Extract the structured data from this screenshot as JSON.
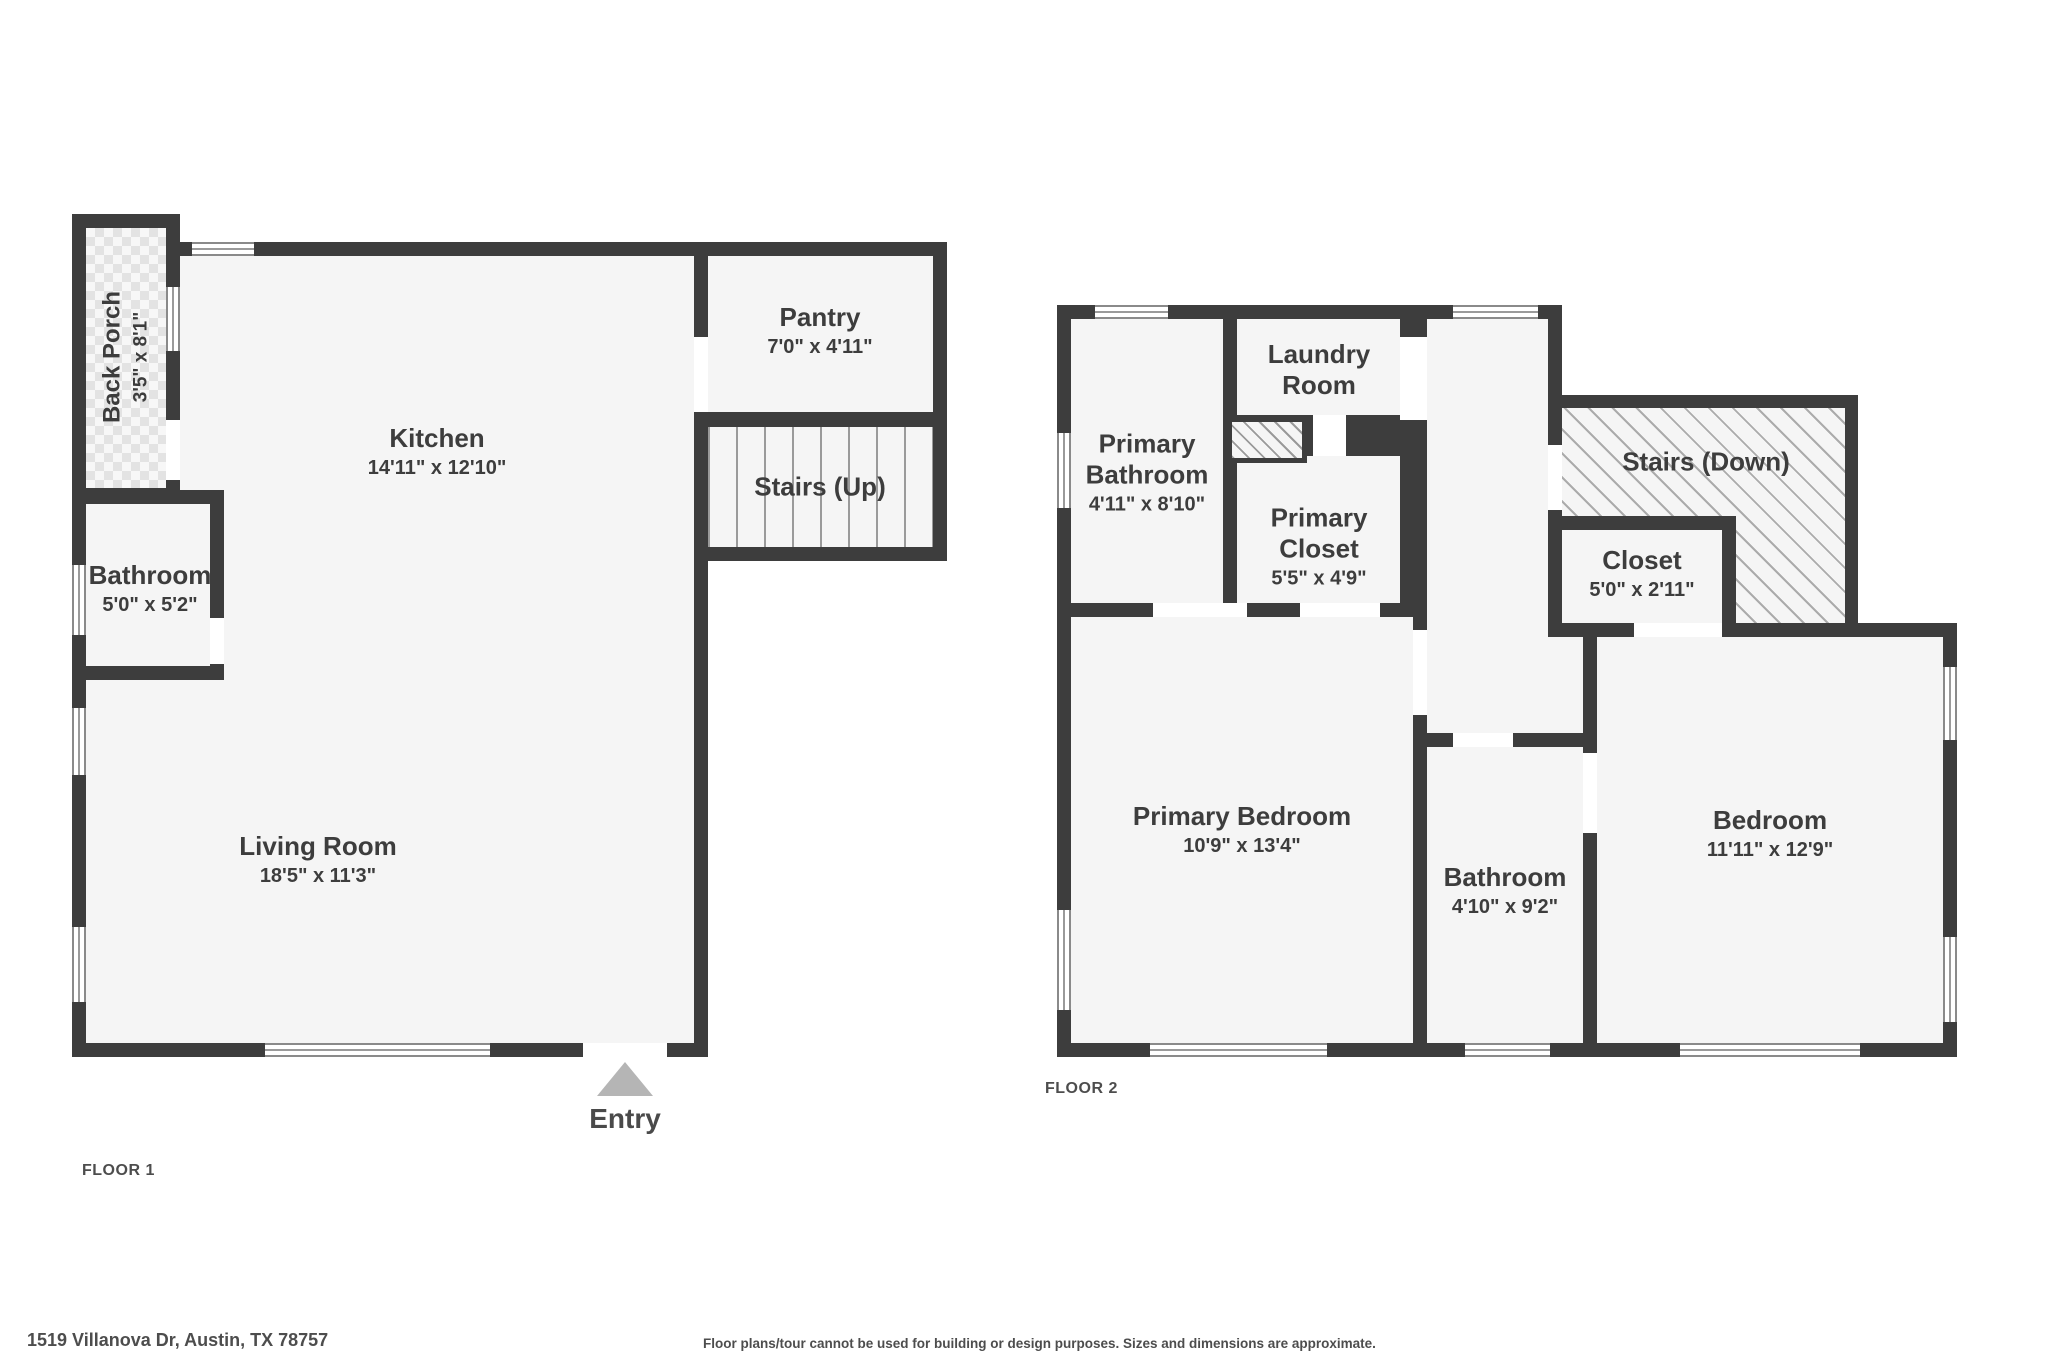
{
  "meta": {
    "entry_label": "Entry",
    "address": "1519 Villanova Dr, Austin, TX 78757",
    "disclaimer": "Floor plans/tour cannot be used for building or design purposes. Sizes and dimensions are approximate."
  },
  "colors": {
    "wall": "#3d3d3d",
    "room_fill": "#f5f5f5",
    "window_frame": "#8a8a8a",
    "entry_arrow": "#b5b5b5",
    "label_text": "#3d3d3d"
  },
  "floor1": {
    "label": "FLOOR 1",
    "rooms": {
      "back_porch": {
        "name": "Back Porch",
        "dims": "3'5\" x 8'1\""
      },
      "kitchen": {
        "name": "Kitchen",
        "dims": "14'11\" x 12'10\""
      },
      "pantry": {
        "name": "Pantry",
        "dims": "7'0\" x 4'11\""
      },
      "stairs_up": {
        "name": "Stairs (Up)"
      },
      "bathroom": {
        "name": "Bathroom",
        "dims": "5'0\" x 5'2\""
      },
      "living_room": {
        "name": "Living Room",
        "dims": "18'5\" x 11'3\""
      }
    }
  },
  "floor2": {
    "label": "FLOOR 2",
    "rooms": {
      "primary_bathroom": {
        "name": "Primary Bathroom",
        "dims": "4'11\" x 8'10\""
      },
      "laundry_room": {
        "name": "Laundry Room"
      },
      "primary_closet": {
        "name": "Primary Closet",
        "dims": "5'5\" x 4'9\""
      },
      "stairs_down": {
        "name": "Stairs (Down)"
      },
      "closet": {
        "name": "Closet",
        "dims": "5'0\" x 2'11\""
      },
      "primary_bedroom": {
        "name": "Primary Bedroom",
        "dims": "10'9\" x 13'4\""
      },
      "bathroom": {
        "name": "Bathroom",
        "dims": "4'10\" x 9'2\""
      },
      "bedroom": {
        "name": "Bedroom",
        "dims": "11'11\" x 12'9\""
      }
    }
  }
}
